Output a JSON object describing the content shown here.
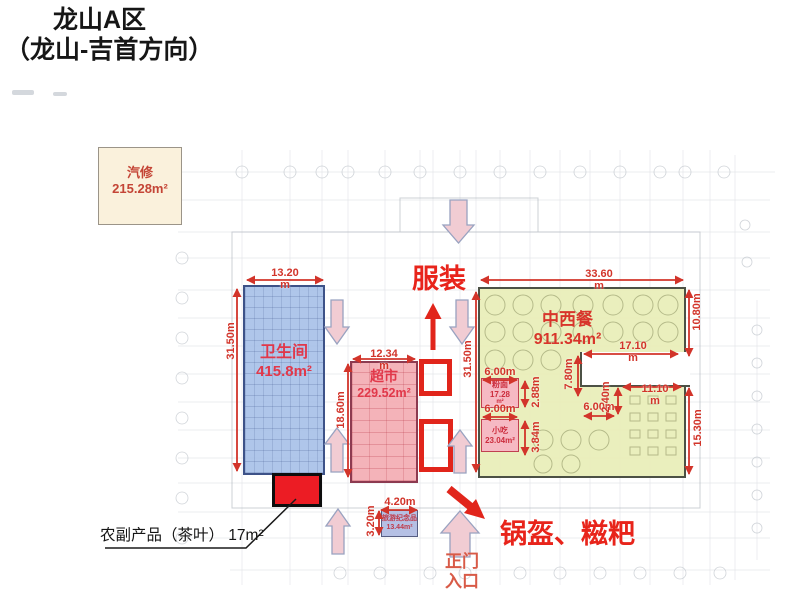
{
  "title": {
    "line1": "龙山A区",
    "line2": "（龙山-吉首方向）"
  },
  "zones": {
    "qixiu": {
      "name": "汽修",
      "area": "215.28m²"
    },
    "weishengjian": {
      "name": "卫生间",
      "area": "415.8m²"
    },
    "chaoshi": {
      "name": "超市",
      "area": "229.52m²"
    },
    "zhongxican": {
      "name": "中西餐",
      "area": "911.34m²"
    },
    "fenmian": {
      "name": "粉面",
      "area": "17.28",
      "unit": "m²"
    },
    "xiaochi": {
      "name": "小吃",
      "area": "23.04m²"
    },
    "lvyoujinianpin": {
      "name": "旅游纪念品",
      "area": "13.44m²"
    },
    "nongfuchanpin": {
      "label": "农副产品（茶叶） 17m²"
    }
  },
  "annotations": {
    "fuzhuang": "服装",
    "guokui_ciba": "锅盔、糍粑",
    "zhengmen_line1": "正门",
    "zhengmen_line2": "入口"
  },
  "dims": [
    {
      "label": "13.20",
      "sub": "m"
    },
    {
      "label": "31.50m"
    },
    {
      "label": "12.34",
      "sub": "m"
    },
    {
      "label": "18.60m"
    },
    {
      "label": "31.50m"
    },
    {
      "label": "33.60",
      "sub": "m"
    },
    {
      "label": "10.80m"
    },
    {
      "label": "17.10",
      "sub": "m"
    },
    {
      "label": "7.80m"
    },
    {
      "label": "2.88m"
    },
    {
      "label": "3.84m"
    },
    {
      "label": "6.00m"
    },
    {
      "label": "6.00m"
    },
    {
      "label": "6.00m"
    },
    {
      "label": "2.40m"
    },
    {
      "label": "11.10",
      "sub": "m"
    },
    {
      "label": "15.30m"
    },
    {
      "label": "4.20m"
    },
    {
      "label": "3.20m"
    }
  ],
  "colors": {
    "zone_blue": "#a4bee7",
    "zone_pink": "#f3acb3",
    "zone_green": "#e9eebb",
    "zone_cream": "#faf1dc",
    "highlight_red": "#ec1c24",
    "dimension_red": "#d2342a",
    "annotation_red": "#e8241b",
    "flow_arrow_pink": "#f1ccd3"
  }
}
